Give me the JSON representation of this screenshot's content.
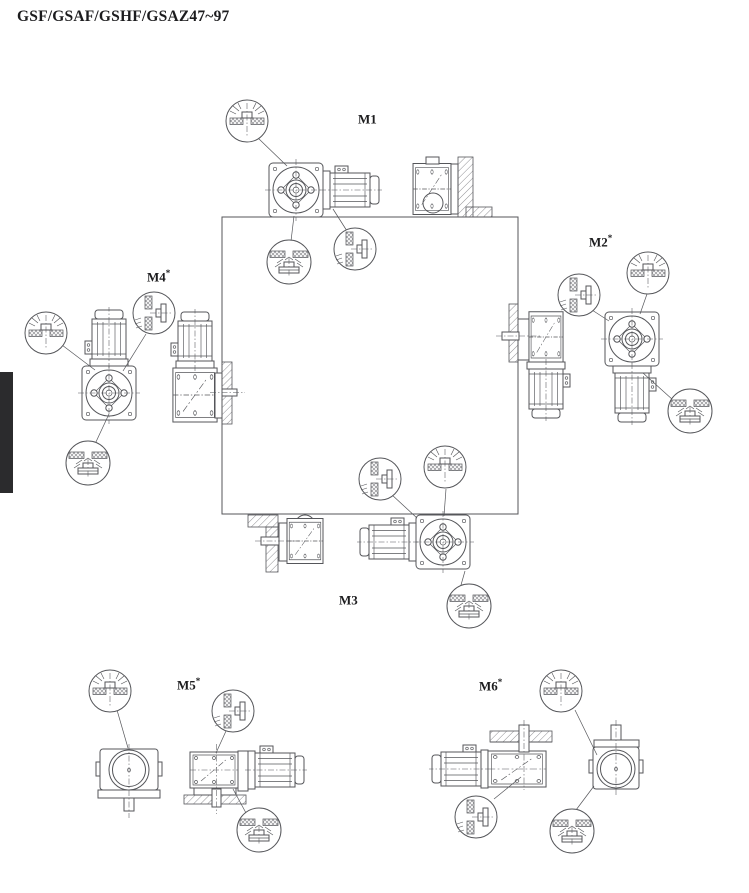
{
  "page": {
    "title": "GSF/GSAF/GSHF/GSAZ47~97"
  },
  "positions": [
    {
      "id": "M1",
      "label": "M1",
      "sup": ""
    },
    {
      "id": "M2",
      "label": "M2",
      "sup": "*"
    },
    {
      "id": "M3",
      "label": "M3",
      "sup": ""
    },
    {
      "id": "M4",
      "label": "M4",
      "sup": "*"
    },
    {
      "id": "M5",
      "label": "M5",
      "sup": "*"
    },
    {
      "id": "M6",
      "label": "M6",
      "sup": "*"
    }
  ],
  "symbols": {
    "breather": "breather-plug-detail",
    "vent": "oil-level-plug-detail",
    "drain": "oil-drain-plug-detail"
  },
  "colors": {
    "line": "#55565a",
    "text": "#1c1c1e",
    "tab": "#2b2b2d",
    "hatch": "#909094",
    "bg": "#ffffff"
  }
}
